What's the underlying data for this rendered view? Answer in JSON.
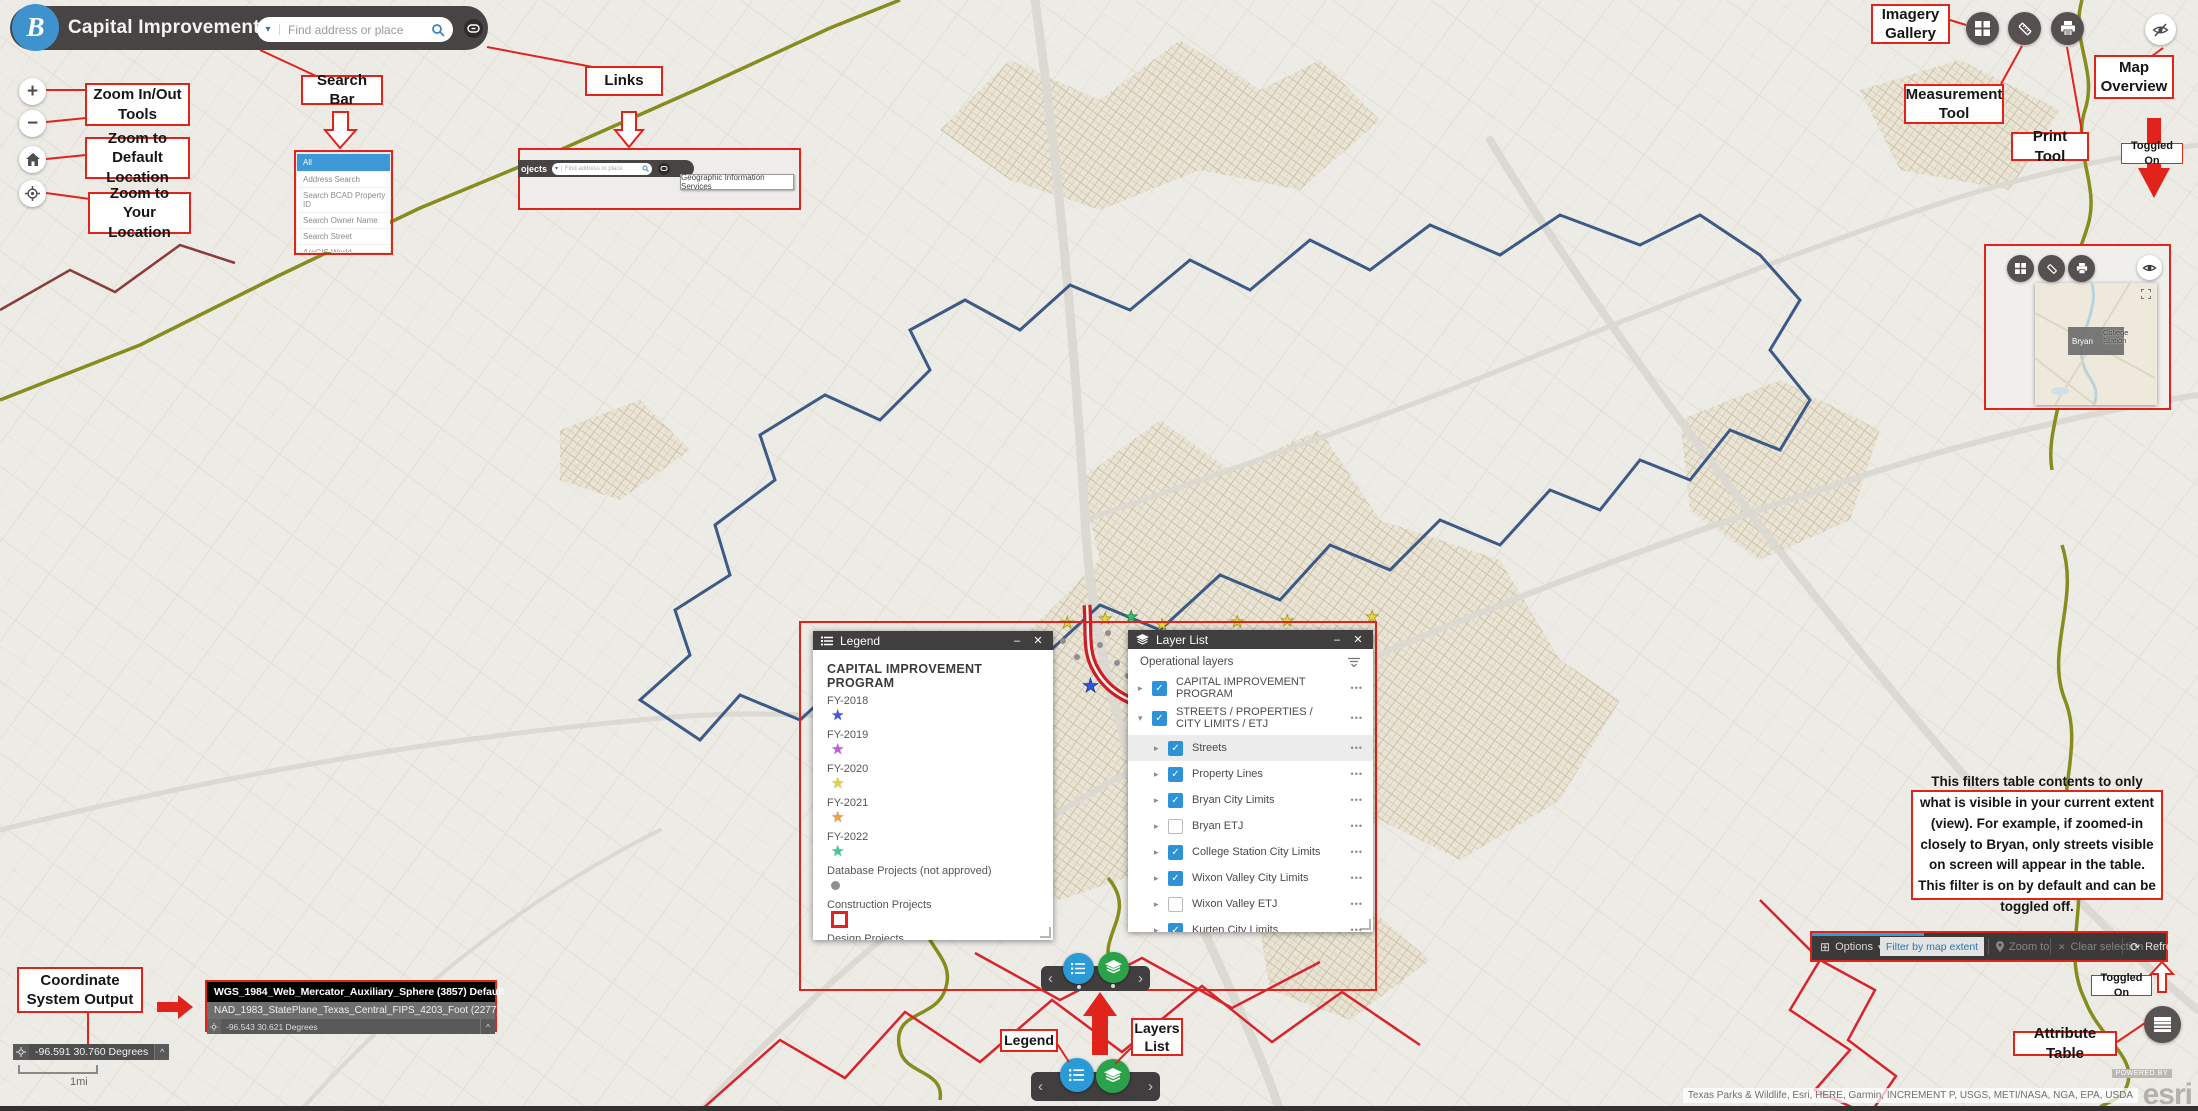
{
  "header": {
    "logo_letter": "B",
    "title": "Capital Improvement Projects",
    "search_placeholder": "Find address or place"
  },
  "left_tools": {
    "zoom_in": "+",
    "zoom_out": "−"
  },
  "annotations": {
    "zoom_in_out": "Zoom In/Out Tools",
    "zoom_default": "Zoom to Default Location",
    "zoom_your": "Zoom to Your Location",
    "search_bar": "Search Bar",
    "links": "Links",
    "imagery_gallery": "Imagery Gallery",
    "measurement_tool": "Measurement Tool",
    "print_tool": "Print Tool",
    "map_overview": "Map Overview",
    "toggled_on_top": "Toggled On",
    "coordinate_system_output": "Coordinate System Output",
    "legend": "Legend",
    "layers_list": "Layers List",
    "filter_note": "This filters table contents to only what is visible in your current extent (view). For example, if zoomed-in closely to Bryan, only streets visible on screen will appear in the table. This filter is on by default and can be toggled off.",
    "toggled_on_bottom": "Toggled On",
    "attribute_table": "Attribute Table"
  },
  "search_dropdown": {
    "selected": "All",
    "items": [
      "All",
      "Address Search",
      "Search BCAD Property ID",
      "Search Owner Name",
      "Search Street",
      "ArcGIS World Geocoding Service"
    ]
  },
  "links_popup": {
    "title_fragment": "ojects",
    "search_placeholder": "Find address or place",
    "tooltip": "Geographic Information Services"
  },
  "legend_window": {
    "title": "Legend",
    "heading": "CAPITAL IMPROVEMENT PROGRAM",
    "items": [
      {
        "label": "FY-2018",
        "symbol": "star",
        "color": "#3b57e8"
      },
      {
        "label": "FY-2019",
        "symbol": "star",
        "color": "#c55ae0"
      },
      {
        "label": "FY-2020",
        "symbol": "star",
        "color": "#e5d33c"
      },
      {
        "label": "FY-2021",
        "symbol": "star",
        "color": "#e9a33b"
      },
      {
        "label": "FY-2022",
        "symbol": "star",
        "color": "#30cf9a"
      },
      {
        "label": "Database Projects (not approved)",
        "symbol": "dot",
        "color": "#8f8f8f"
      },
      {
        "label": "Construction Projects",
        "symbol": "square",
        "color": "#e02424"
      },
      {
        "label": "Design Projects",
        "symbol": "square",
        "color": "#4a7d3a"
      }
    ]
  },
  "layer_list_window": {
    "title": "Layer List",
    "section": "Operational layers",
    "layers": [
      {
        "label": "CAPITAL IMPROVEMENT PROGRAM",
        "checked": true
      },
      {
        "label": "STREETS / PROPERTIES / CITY LIMITS / ETJ",
        "checked": true
      },
      {
        "label": "Streets",
        "checked": true
      },
      {
        "label": "Property Lines",
        "checked": true
      },
      {
        "label": "Bryan City Limits",
        "checked": true
      },
      {
        "label": "Bryan ETJ",
        "checked": false
      },
      {
        "label": "College Station City Limits",
        "checked": true
      },
      {
        "label": "Wixon Valley City Limits",
        "checked": true
      },
      {
        "label": "Wixon Valley ETJ",
        "checked": false
      },
      {
        "label": "Kurten City Limits",
        "checked": true
      }
    ]
  },
  "coordinate_widget": {
    "value": "-96.591 30.760 Degrees"
  },
  "coordinate_popup": {
    "row1": "WGS_1984_Web_Mercator_Auxiliary_Sphere (3857) Default",
    "row2": "NAD_1983_StatePlane_Texas_Central_FIPS_4203_Foot (2277)",
    "row3": "-96.543 30.621 Degrees"
  },
  "scale_bar": {
    "label": "1mi"
  },
  "attribute_toolbar": {
    "options": "Options",
    "filter_by_map_extent": "Filter by map extent",
    "zoom_to": "Zoom to",
    "clear_selection": "Clear selection",
    "refresh": "Refresh"
  },
  "overview_inset": {
    "city1": "Bryan",
    "city2": "College Station"
  },
  "attribution": {
    "text": "Texas Parks & Wildlife, Esri, HERE, Garmin, INCREMENT P, USGS, METI/NASA, NGA, EPA, USDA",
    "powered_by": "POWERED BY",
    "brand": "esri"
  },
  "colors": {
    "annotation_red": "#e0241c",
    "header_dark": "#474443",
    "checkbox_blue": "#2e93d6",
    "dock_blue": "#2b9bd7",
    "dock_green": "#2ba24a",
    "city_limits_blue": "#3b5a86",
    "etj_olive": "#868c1d",
    "boundary_red": "#d8242c"
  },
  "icons": {
    "search": "magnifier",
    "link": "chain-link",
    "grid": "imagery-grid",
    "ruler": "measure",
    "printer": "print",
    "eye_slash": "overview-toggle",
    "home": "default-extent",
    "locate": "my-location",
    "layers": "layer-stack",
    "legend": "legend-list",
    "table": "attribute-table",
    "crosshair": "coordinate-crosshair"
  }
}
